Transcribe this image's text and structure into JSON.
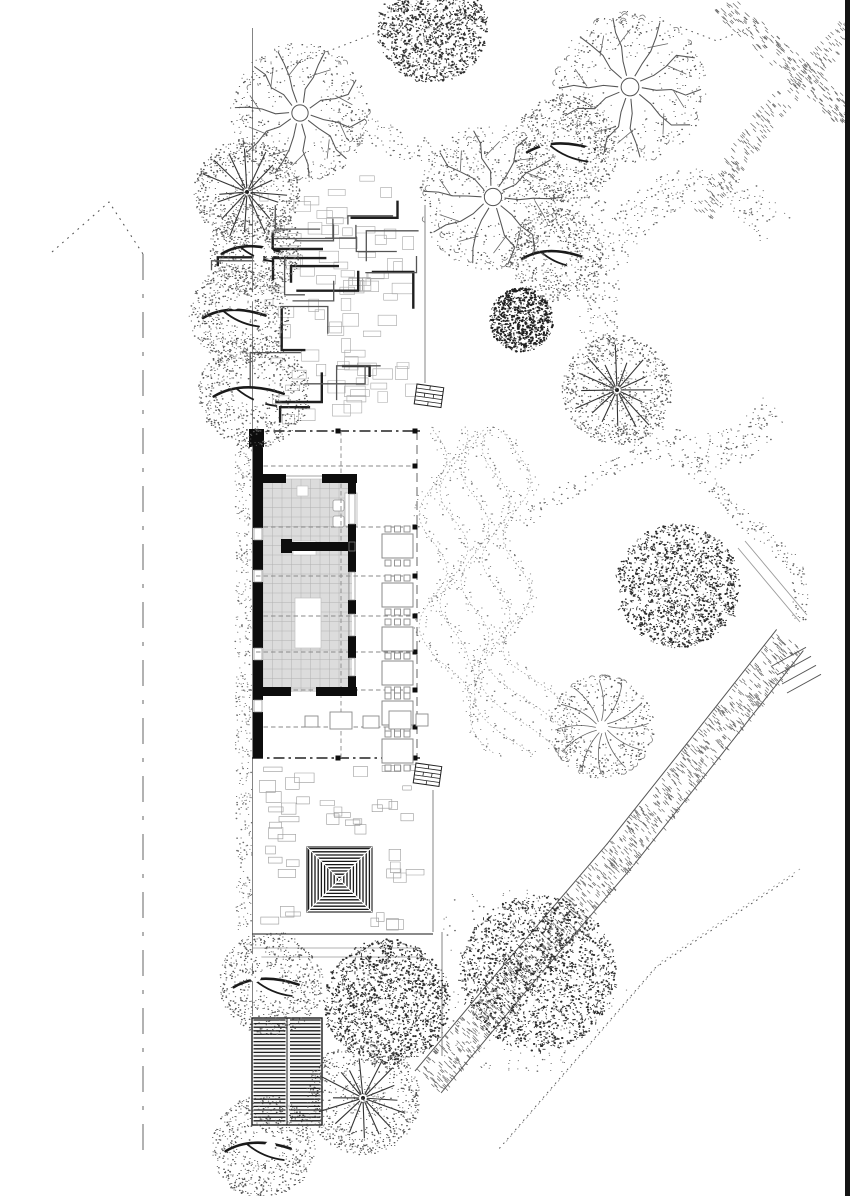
{
  "canvas": {
    "w": 850,
    "h": 1196
  },
  "palette": {
    "ink": "#0d0d0d",
    "ink_soft": "#2d2d2d",
    "line_mid": "#555555",
    "line_light": "#999999",
    "dash": "#8a8a8a",
    "chain": "#222222",
    "floor_fill": "#dcdcdc",
    "floor_grid": "#b2b2b2",
    "stipple": "#666666",
    "white": "#ffffff",
    "page_edge": "#141414"
  },
  "page_edge_bar": {
    "x": 845,
    "y": 0,
    "w": 5,
    "h": 1196
  },
  "property_boundary": {
    "apex": [
      109,
      202
    ],
    "left_end": [
      52,
      252
    ],
    "right_end": [
      143,
      254
    ],
    "vertical_x": 143,
    "vertical_y1": 254,
    "vertical_y2": 1158
  },
  "site_lines": {
    "west_edge": {
      "x": 252.5,
      "y1": 28,
      "y2": 1016
    },
    "north_court_right": {
      "x": 425,
      "y1": 205,
      "y2": 383
    },
    "south_court_right": {
      "x": 433,
      "y1": 790,
      "y2": 932
    },
    "south_east_edge": {
      "x": 442,
      "y1": 932,
      "y2": 1056
    },
    "court_bottom_main": [
      252,
      934,
      433,
      934
    ],
    "court_bottom_a": [
      253,
      948,
      420,
      948
    ],
    "court_bottom_b": [
      255,
      957,
      418,
      957
    ]
  },
  "north_courtyard": {
    "x": 252,
    "y": 205,
    "w": 173,
    "h": 223,
    "maze_count": 26,
    "pave_count": 80
  },
  "south_courtyard": {
    "x": 252,
    "y": 760,
    "w": 181,
    "h": 172,
    "pave_count": 66
  },
  "building": {
    "chain_rows_y": [
      431,
      758
    ],
    "chain_x1": 252,
    "chain_x2": 420,
    "dash_rows_y": [
      466,
      527,
      576,
      616,
      652,
      690,
      727
    ],
    "dash_x1": 256,
    "dash_x2": 416,
    "grid_col_x": 341,
    "veranda_col_x": 417,
    "columns": [
      [
        415,
        431
      ],
      [
        415,
        466
      ],
      [
        415,
        527
      ],
      [
        415,
        576
      ],
      [
        415,
        616
      ],
      [
        415,
        652
      ],
      [
        415,
        690
      ],
      [
        415,
        727
      ],
      [
        415,
        758
      ],
      [
        338,
        431
      ],
      [
        338,
        758
      ]
    ],
    "left_wall": {
      "x": 253,
      "w": 10,
      "segments": [
        [
          429,
          528
        ],
        [
          540,
          570
        ],
        [
          582,
          648
        ],
        [
          660,
          700
        ],
        [
          712,
          758
        ]
      ],
      "gaps": [
        [
          528,
          540
        ],
        [
          570,
          582
        ],
        [
          648,
          660
        ],
        [
          700,
          712
        ]
      ]
    },
    "top_block": [
      249,
      429,
      15,
      18
    ],
    "floor": {
      "x": 263,
      "y": 479,
      "w": 89,
      "h": 213,
      "tile": 9.5
    },
    "top_wall": {
      "y": 474,
      "h": 9,
      "runs": [
        [
          255,
          286
        ],
        [
          322,
          357
        ]
      ],
      "gap": [
        286,
        322
      ]
    },
    "mid_wall": {
      "y": 542,
      "h": 9,
      "runs": [
        [
          287,
          356
        ]
      ],
      "block": [
        281,
        539,
        11,
        14
      ]
    },
    "bottom_wall": {
      "y": 687,
      "h": 9,
      "runs": [
        [
          262,
          291
        ],
        [
          316,
          357
        ]
      ]
    },
    "right_wall": {
      "x": 348,
      "w": 8,
      "segments": [
        [
          483,
          494
        ],
        [
          524,
          542
        ],
        [
          551,
          572
        ],
        [
          600,
          614
        ],
        [
          636,
          658
        ],
        [
          676,
          687
        ]
      ]
    },
    "white_insets": [
      [
        295,
        598,
        26,
        50
      ],
      [
        293,
        541,
        23,
        14
      ],
      [
        297,
        486,
        11,
        10
      ]
    ],
    "fixtures": [
      [
        333,
        500,
        11,
        11
      ],
      [
        333,
        516,
        11,
        11
      ]
    ],
    "door_rect": [
      345,
      493,
      12,
      33
    ],
    "tables": {
      "x": 382,
      "w": 31,
      "h": 24,
      "rows_y": [
        534,
        583,
        627,
        661,
        701,
        739
      ],
      "chair": 6
    },
    "mid_tables": [
      [
        330,
        712,
        22,
        17
      ],
      [
        363,
        716,
        16,
        12
      ],
      [
        389,
        711,
        22,
        18
      ],
      [
        305,
        716,
        13,
        11
      ],
      [
        416,
        714,
        12,
        12
      ]
    ]
  },
  "pavilion": {
    "x": 307,
    "y": 847,
    "size": 65,
    "stripe": 3.2
  },
  "deck": {
    "x": 252,
    "y": 1018,
    "w": 70,
    "h": 107,
    "stripe": 3.6,
    "divider_x": 287
  },
  "gates": [
    {
      "x": 417,
      "y": 384,
      "w": 27,
      "h": 20,
      "rot": 8
    },
    {
      "x": 416,
      "y": 763,
      "w": 26,
      "h": 20,
      "rot": 8
    }
  ],
  "terraces": {
    "x0": 433,
    "y0": 430,
    "y1": 758,
    "bands": 5,
    "spacing": 21,
    "amp": 14,
    "period": 112
  },
  "ground_strips": [
    {
      "x": 235,
      "y": 432,
      "w": 17,
      "h": 326,
      "n": 330
    },
    {
      "x": 236,
      "y": 762,
      "w": 16,
      "h": 168,
      "n": 150
    }
  ],
  "trees": [
    {
      "cx": 300,
      "cy": 113,
      "r": 68,
      "style": "snowflake"
    },
    {
      "cx": 247,
      "cy": 192,
      "r": 52,
      "style": "radial"
    },
    {
      "cx": 255,
      "cy": 250,
      "r": 46,
      "style": "stipple"
    },
    {
      "cx": 239,
      "cy": 314,
      "r": 50,
      "style": "stipple"
    },
    {
      "cx": 254,
      "cy": 392,
      "r": 56,
      "style": "stipple"
    },
    {
      "cx": 432,
      "cy": 28,
      "r": 55,
      "style": "leafyDark"
    },
    {
      "cx": 493,
      "cy": 197,
      "r": 72,
      "style": "snowflake"
    },
    {
      "cx": 566,
      "cy": 148,
      "r": 54,
      "style": "stipple"
    },
    {
      "cx": 630,
      "cy": 87,
      "r": 74,
      "style": "snowflake"
    },
    {
      "cx": 556,
      "cy": 255,
      "r": 47,
      "style": "stipple"
    },
    {
      "cx": 521,
      "cy": 320,
      "r": 32,
      "style": "darkBush"
    },
    {
      "cx": 617,
      "cy": 390,
      "r": 54,
      "style": "radial"
    },
    {
      "cx": 678,
      "cy": 586,
      "r": 62,
      "style": "leafyDark"
    },
    {
      "cx": 602,
      "cy": 727,
      "r": 52,
      "style": "leafyLight"
    },
    {
      "cx": 538,
      "cy": 973,
      "r": 78,
      "style": "leafyDark"
    },
    {
      "cx": 271,
      "cy": 983,
      "r": 52,
      "style": "stipple"
    },
    {
      "cx": 387,
      "cy": 1002,
      "r": 63,
      "style": "leafyDark"
    },
    {
      "cx": 363,
      "cy": 1098,
      "r": 56,
      "style": "radial"
    },
    {
      "cx": 263,
      "cy": 1147,
      "r": 52,
      "style": "stipple"
    }
  ],
  "stipple_paths": [
    {
      "kind": "band",
      "pts": [
        [
          330,
          118
        ],
        [
          420,
          152
        ],
        [
          500,
          186
        ],
        [
          605,
          215
        ]
      ],
      "w": 30,
      "density": 0.3,
      "mode": "dot"
    },
    {
      "kind": "ring",
      "cx": 700,
      "cy": 320,
      "rx": 102,
      "ry": 133,
      "width": 38,
      "gap1": -42,
      "gap2": 42,
      "density": 0.42
    },
    {
      "kind": "band",
      "pts": [
        [
          718,
          0
        ],
        [
          850,
          118
        ]
      ],
      "w": 26,
      "density": 0.45,
      "mode": "hatch"
    },
    {
      "kind": "band",
      "pts": [
        [
          850,
          25
        ],
        [
          762,
          120
        ],
        [
          700,
          213
        ]
      ],
      "w": 22,
      "density": 0.38,
      "mode": "hatch"
    },
    {
      "kind": "band",
      "pts": [
        [
          688,
          462
        ],
        [
          745,
          520
        ],
        [
          795,
          565
        ],
        [
          802,
          622
        ]
      ],
      "w": 18,
      "density": 0.4,
      "mode": "dot"
    },
    {
      "kind": "band",
      "pts": [
        [
          520,
          522
        ],
        [
          586,
          480
        ],
        [
          648,
          452
        ]
      ],
      "w": 16,
      "density": 0.32,
      "mode": "dot"
    },
    {
      "kind": "lines2",
      "pts": [
        [
          738,
          548
        ],
        [
          800,
          622
        ]
      ],
      "offset": 7
    },
    {
      "kind": "poly",
      "poly": [
        [
          436,
          898
        ],
        [
          530,
          888
        ],
        [
          628,
          988
        ],
        [
          560,
          1086
        ],
        [
          436,
          1058
        ]
      ],
      "density": 0.16
    },
    {
      "kind": "band",
      "pts": [
        [
          790,
          640
        ],
        [
          705,
          748
        ],
        [
          620,
          855
        ]
      ],
      "w": 34,
      "density": 0.5,
      "mode": "hatch",
      "borders": true
    },
    {
      "kind": "band",
      "pts": [
        [
          620,
          855
        ],
        [
          520,
          972
        ],
        [
          428,
          1082
        ]
      ],
      "w": 34,
      "density": 0.5,
      "mode": "hatch",
      "borders": true
    },
    {
      "kind": "steps",
      "at": [
        772,
        666
      ],
      "n": 4,
      "len": 34,
      "gap": 9
    },
    {
      "kind": "dotted",
      "pts": [
        [
          793,
          876
        ],
        [
          655,
          968
        ],
        [
          498,
          1150
        ]
      ],
      "twin": 7
    },
    {
      "kind": "dotted",
      "pts": [
        [
          680,
          27
        ],
        [
          717,
          41
        ],
        [
          758,
          24
        ]
      ],
      "twin": 0
    },
    {
      "kind": "dotted",
      "pts": [
        [
          253,
          80
        ],
        [
          420,
          16
        ]
      ],
      "twin": 0
    }
  ]
}
